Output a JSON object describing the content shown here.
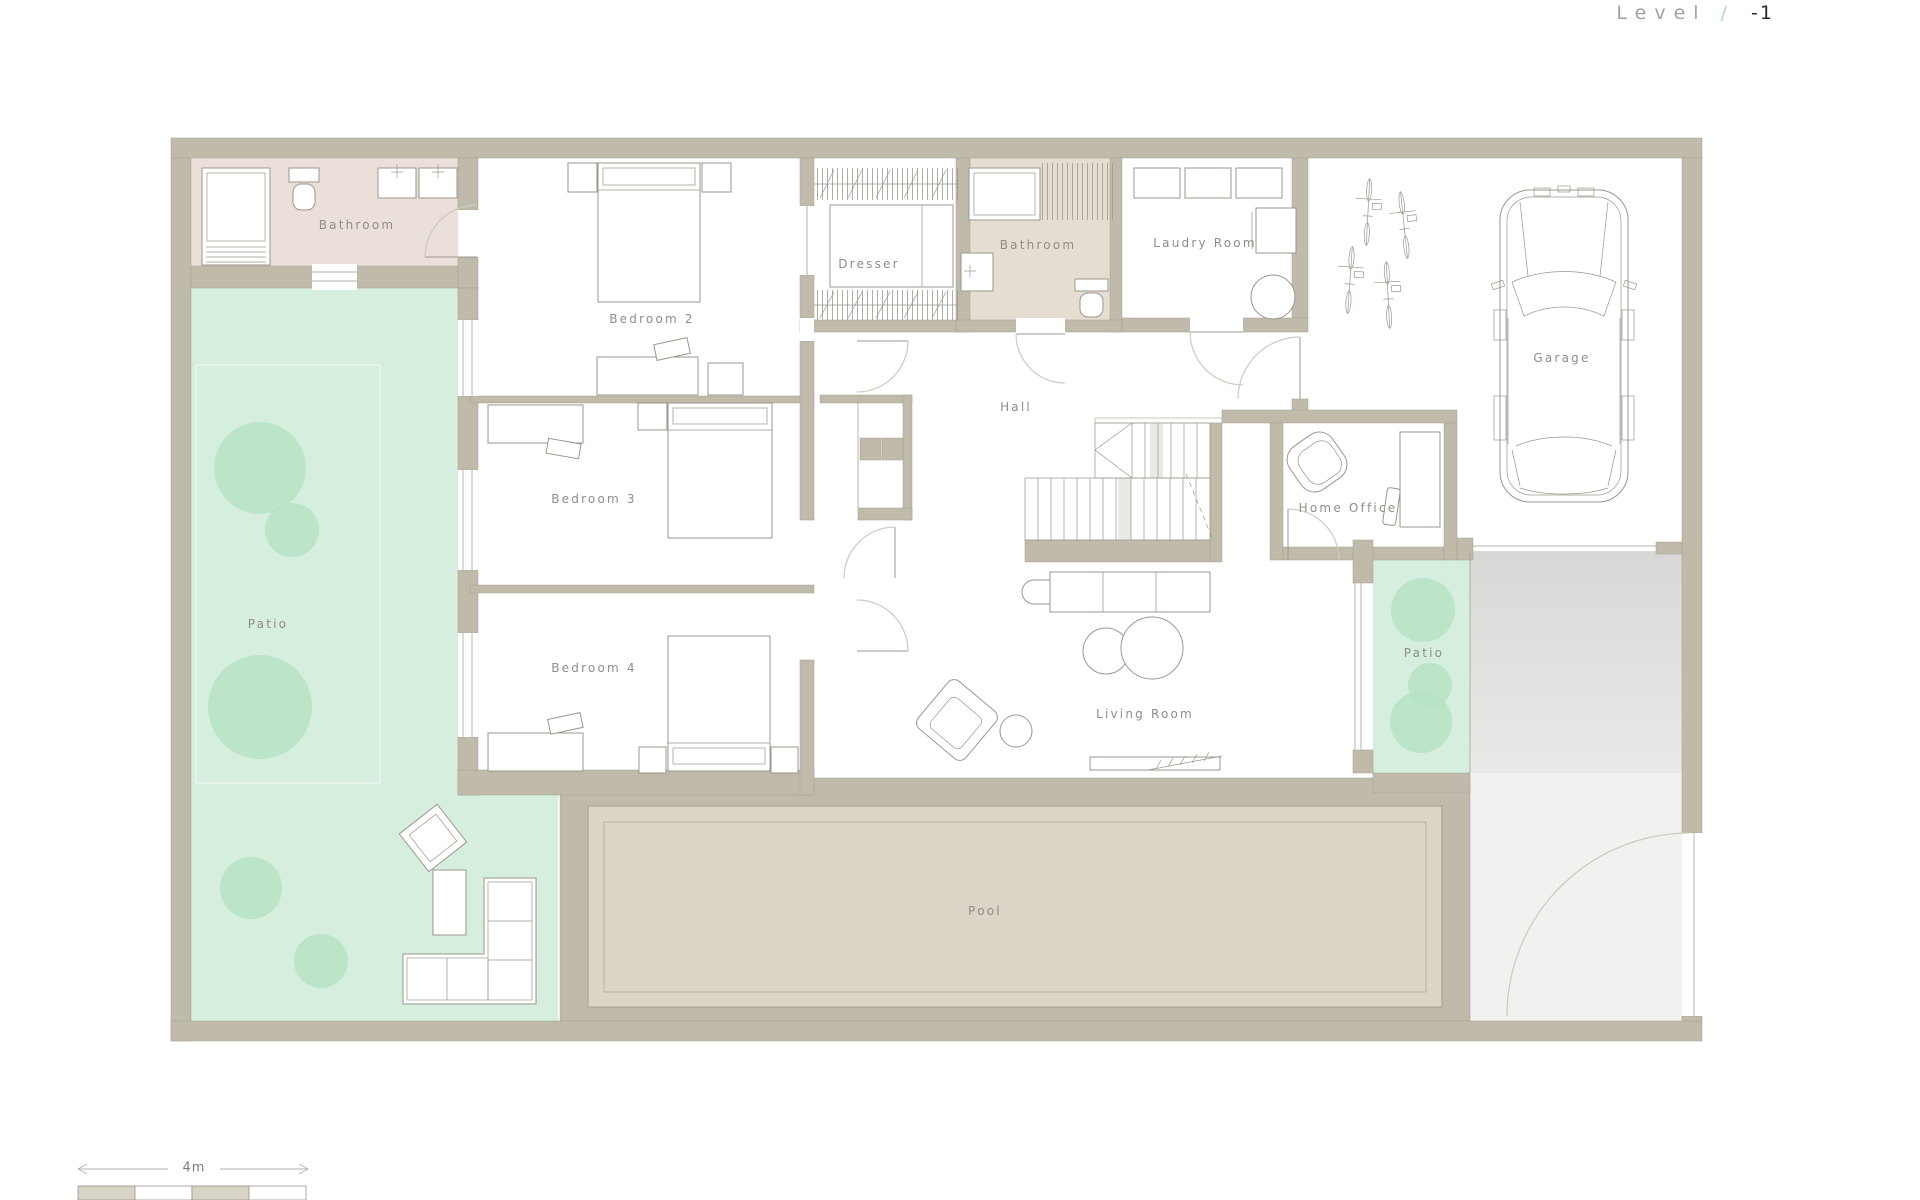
{
  "title": {
    "label": "Level",
    "separator": "/",
    "number": "-1"
  },
  "rooms": {
    "bathroom_upper_left": {
      "label": "Bathroom"
    },
    "bedroom_2": {
      "label": "Bedroom 2"
    },
    "dresser": {
      "label": "Dresser"
    },
    "bathroom_center": {
      "label": "Bathroom"
    },
    "laundry_room": {
      "label": "Laudry Room"
    },
    "garage": {
      "label": "Garage"
    },
    "hall": {
      "label": "Hall"
    },
    "bedroom_3": {
      "label": "Bedroom 3"
    },
    "bedroom_4": {
      "label": "Bedroom 4"
    },
    "home_office": {
      "label": "Home Office"
    },
    "living_room": {
      "label": "Living Room"
    },
    "patio_left": {
      "label": "Patio"
    },
    "patio_right": {
      "label": "Patio"
    },
    "pool": {
      "label": "Pool"
    }
  },
  "scale_bar": {
    "label": "4m"
  },
  "colors": {
    "wall": "#bfbaa9",
    "wall-edge": "#a59f91",
    "bath1": "#eadfd9",
    "bath2": "#e6ddd2",
    "patio": "#d5eede",
    "tree": "#b5e2c4",
    "pool-water": "#dad5c6",
    "drive-a": "#d8d8d7",
    "drive-b": "#f1f1ef",
    "furniture": "#9b978c",
    "door": "#cfccc2",
    "label": "#8e8e88",
    "title": "#a2a2a0",
    "title-slash": "#b5d2d5",
    "title-number": "#2b2b2b"
  }
}
